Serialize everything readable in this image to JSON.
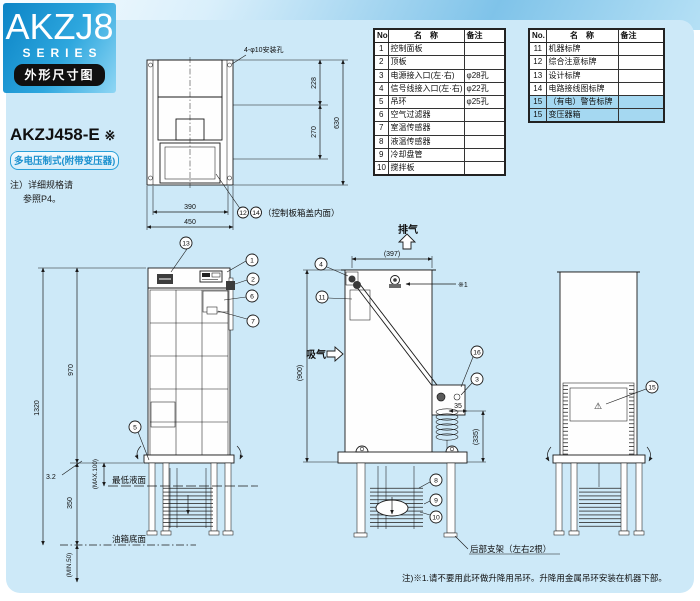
{
  "header": {
    "logo_title": "AKZJ8",
    "logo_subtitle": "SERIES",
    "section_badge": "外形尺寸图"
  },
  "model": {
    "name": "AKZJ458-E",
    "ref_mark": "※",
    "variant": "多电压制式(附带变压器)",
    "note_line1": "注）详细规格请",
    "note_line2": "参照P4。"
  },
  "parts_table_left": {
    "col_no": "No.",
    "col_name": "名　称",
    "col_remark": "备注",
    "rows": [
      {
        "no": "1",
        "name": "控制面板",
        "remark": ""
      },
      {
        "no": "2",
        "name": "顶板",
        "remark": ""
      },
      {
        "no": "3",
        "name": "电源接入口(左·右)",
        "remark": "φ28孔"
      },
      {
        "no": "4",
        "name": "信号线接入口(左·右)",
        "remark": "φ22孔"
      },
      {
        "no": "5",
        "name": "吊环",
        "remark": "φ25孔"
      },
      {
        "no": "6",
        "name": "空气过滤器",
        "remark": ""
      },
      {
        "no": "7",
        "name": "室温传感器",
        "remark": ""
      },
      {
        "no": "8",
        "name": "液温传感器",
        "remark": ""
      },
      {
        "no": "9",
        "name": "冷却盘管",
        "remark": ""
      },
      {
        "no": "10",
        "name": "搅拌板",
        "remark": ""
      }
    ]
  },
  "parts_table_right": {
    "col_no": "No.",
    "col_name": "名　称",
    "col_remark": "备注",
    "rows": [
      {
        "no": "11",
        "name": "机器标牌",
        "remark": ""
      },
      {
        "no": "12",
        "name": "综合注意标牌",
        "remark": ""
      },
      {
        "no": "13",
        "name": "设计标牌",
        "remark": ""
      },
      {
        "no": "14",
        "name": "电路接线图标牌",
        "remark": ""
      },
      {
        "no": "15",
        "name": "（有电）警告标牌",
        "remark": ""
      },
      {
        "no": "15",
        "name": "变压器箱",
        "remark": ""
      }
    ]
  },
  "top_view": {
    "hole_label": "4-φ10安装孔",
    "dim_top": "228",
    "dim_mid": "270",
    "dim_total_h": "630",
    "dim_inner_w": "390",
    "dim_outer_w": "450",
    "callout_a": "12",
    "callout_b": "14",
    "callout_text": "（控制板箱盖内面）"
  },
  "front_view": {
    "c13": "13",
    "c1": "1",
    "c2": "2",
    "c6": "6",
    "c7": "7",
    "c5": "5",
    "dim_body_h": "970",
    "dim_total_h": "1320",
    "dim_plate": "3.2",
    "max_label": "(MAX.100)",
    "min_liquid_label": "最低液面",
    "dim_leg": "350",
    "tank_bottom_label": "油箱底面",
    "min_label": "(MIN.50)"
  },
  "side_view": {
    "exhaust_label": "排气",
    "intake_label": "吸气",
    "dim_depth": "(397)",
    "dim_height": "(900)",
    "ref_mark": "※1",
    "c4": "4",
    "c11": "11",
    "c16": "16",
    "c3": "3",
    "c8": "8",
    "c9": "9",
    "c10": "10",
    "dim_a": "35",
    "dim_b": "(335)",
    "bracket_label": "后部支架（左右2根）"
  },
  "rear_view": {
    "c15": "15",
    "warning_mark": "⚠"
  },
  "footer": {
    "note": "注)※1.请不要用此环做升降用吊环。升降用金属吊环安装在机器下部。"
  }
}
